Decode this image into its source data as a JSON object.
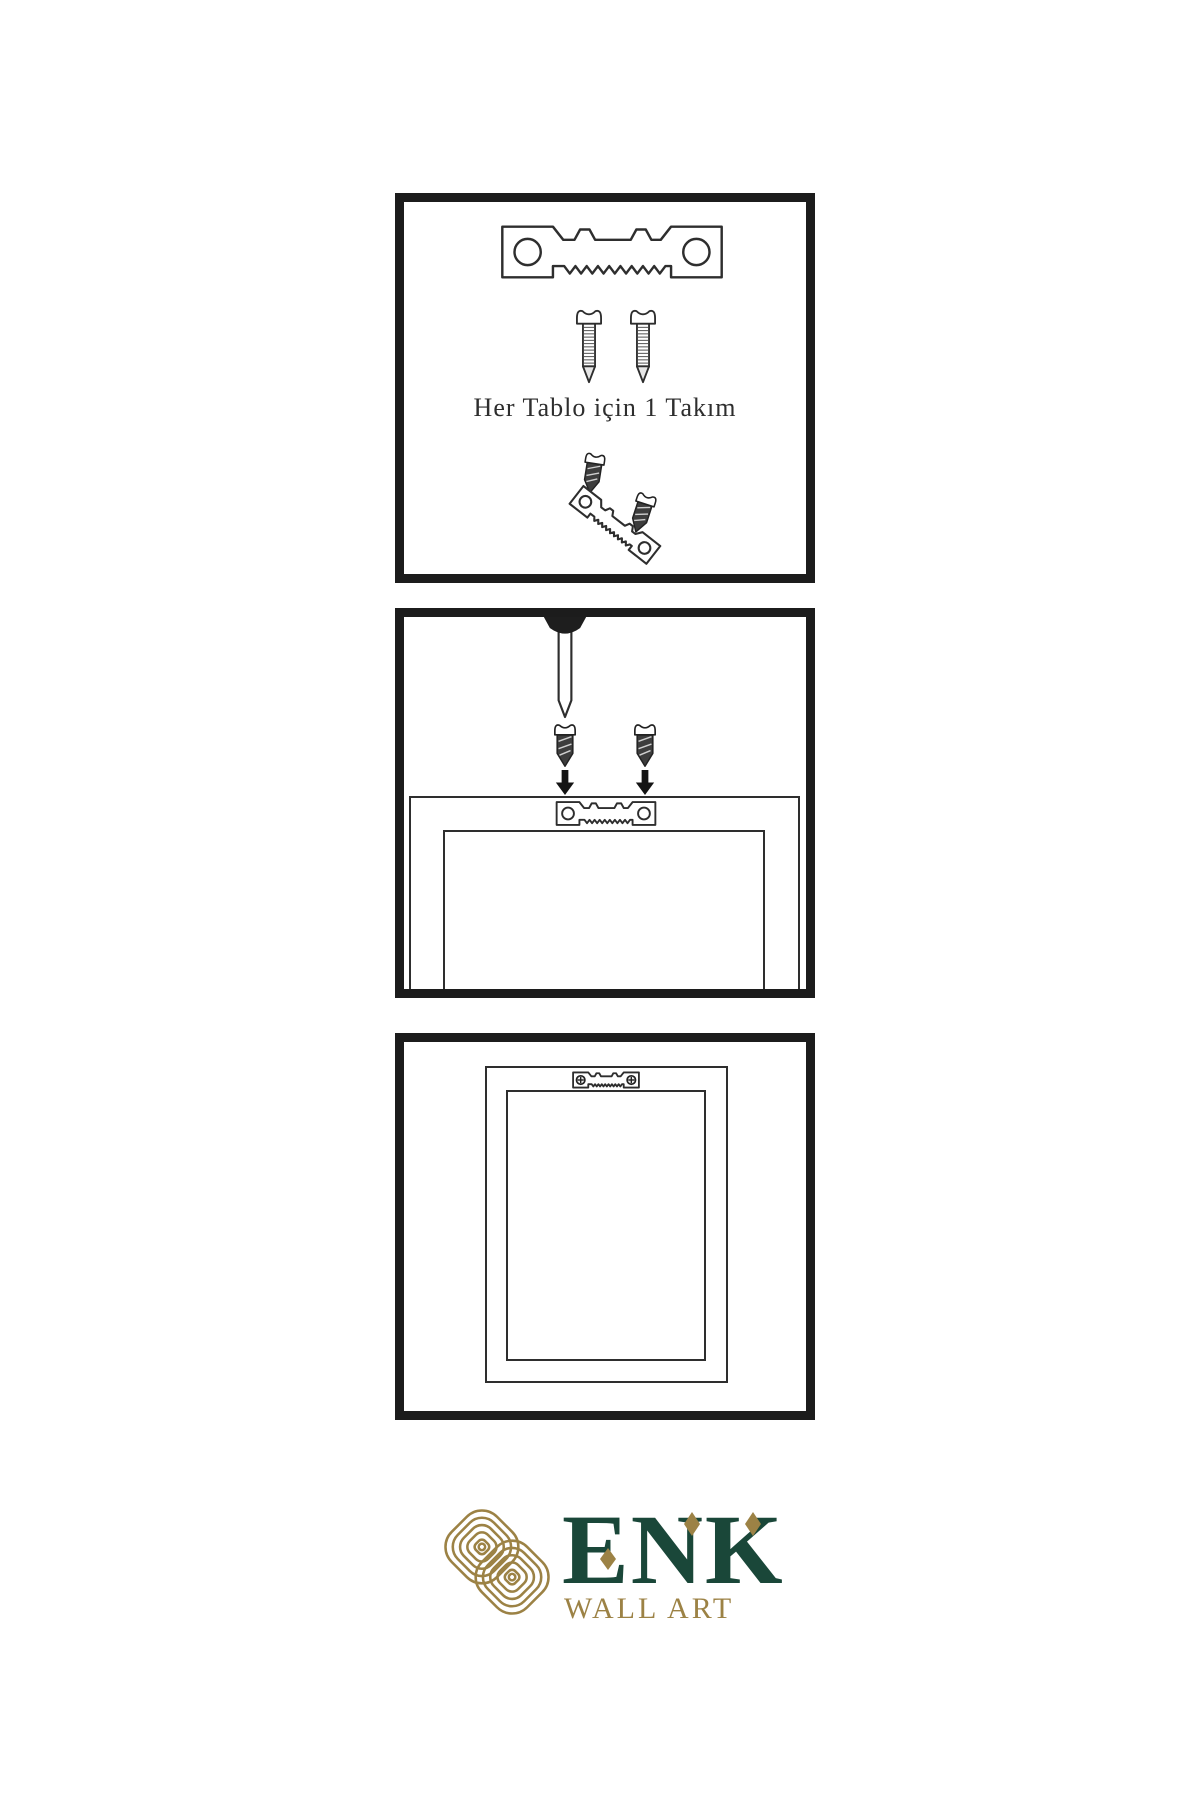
{
  "page": {
    "background_color": "#ffffff"
  },
  "colors": {
    "panel_border": "#1c1c1c",
    "line_art": "#2e2e2e",
    "screw_dark_fill": "#3d3d3d",
    "brand_green": "#1a4739",
    "brand_gold": "#9c8245"
  },
  "steps": {
    "step1": {
      "caption": "Her Tablo için 1 Takım",
      "icons": [
        "sawtooth-hanger-icon",
        "screw-icon",
        "screw-icon",
        "dark-screw-icon",
        "angled-sawtooth-hanger-icon",
        "dark-screw-icon"
      ]
    },
    "step2": {
      "icons": [
        "wall-nail-icon",
        "dark-screw-icon",
        "dark-screw-icon",
        "down-arrow-icon",
        "down-arrow-icon",
        "sawtooth-hanger-icon",
        "frame-back-icon"
      ]
    },
    "step3": {
      "icons": [
        "framed-picture-icon",
        "mounted-hanger-with-screws-icon"
      ]
    }
  },
  "brand": {
    "logo_icon": "knot-logo-icon",
    "name": "ENK",
    "subtitle": "WALL ART"
  }
}
